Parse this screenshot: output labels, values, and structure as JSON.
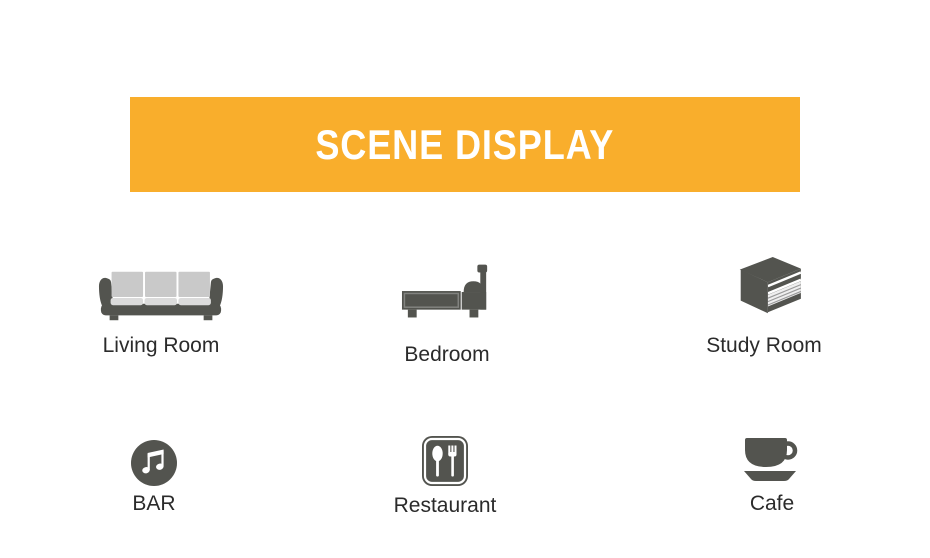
{
  "banner": {
    "title": "SCENE DISPLAY"
  },
  "scenes": [
    {
      "id": "living-room",
      "label": "Living Room",
      "icon": "sofa-icon"
    },
    {
      "id": "bedroom",
      "label": "Bedroom",
      "icon": "bed-icon"
    },
    {
      "id": "study-room",
      "label": "Study Room",
      "icon": "books-icon"
    },
    {
      "id": "bar",
      "label": "BAR",
      "icon": "music-note-icon"
    },
    {
      "id": "restaurant",
      "label": "Restaurant",
      "icon": "fork-spoon-icon"
    },
    {
      "id": "cafe",
      "label": "Cafe",
      "icon": "coffee-cup-icon"
    }
  ],
  "colors": {
    "page_bg": "#FFFFFF",
    "banner_bg": "#F9AE2C",
    "banner_text": "#FFFFFF",
    "icon_dark": "#53544F",
    "cushion_light": "#C9C9C9",
    "seat_light": "#DBDBDB",
    "pages": "#EFEFEF",
    "label_text": "#2B2B2B"
  }
}
